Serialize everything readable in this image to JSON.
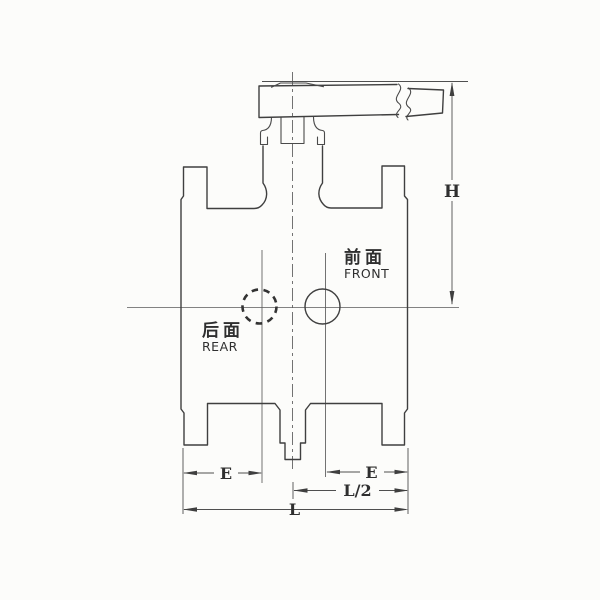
{
  "drawing": {
    "type": "valve-engineering-drawing",
    "labels": {
      "front_cn": "前面",
      "front_en": "FRONT",
      "rear_cn": "后面",
      "rear_en": "REAR"
    },
    "dimensions": {
      "height": "H",
      "end_to_center_left": "E",
      "end_to_center_right": "E",
      "half_length": "L/2",
      "face_to_face": "L"
    },
    "colors": {
      "line": "#3f3f3f",
      "dimension_line": "#4f4f4f",
      "text": "#2f2f2f",
      "background": "#fcfcfa"
    }
  }
}
